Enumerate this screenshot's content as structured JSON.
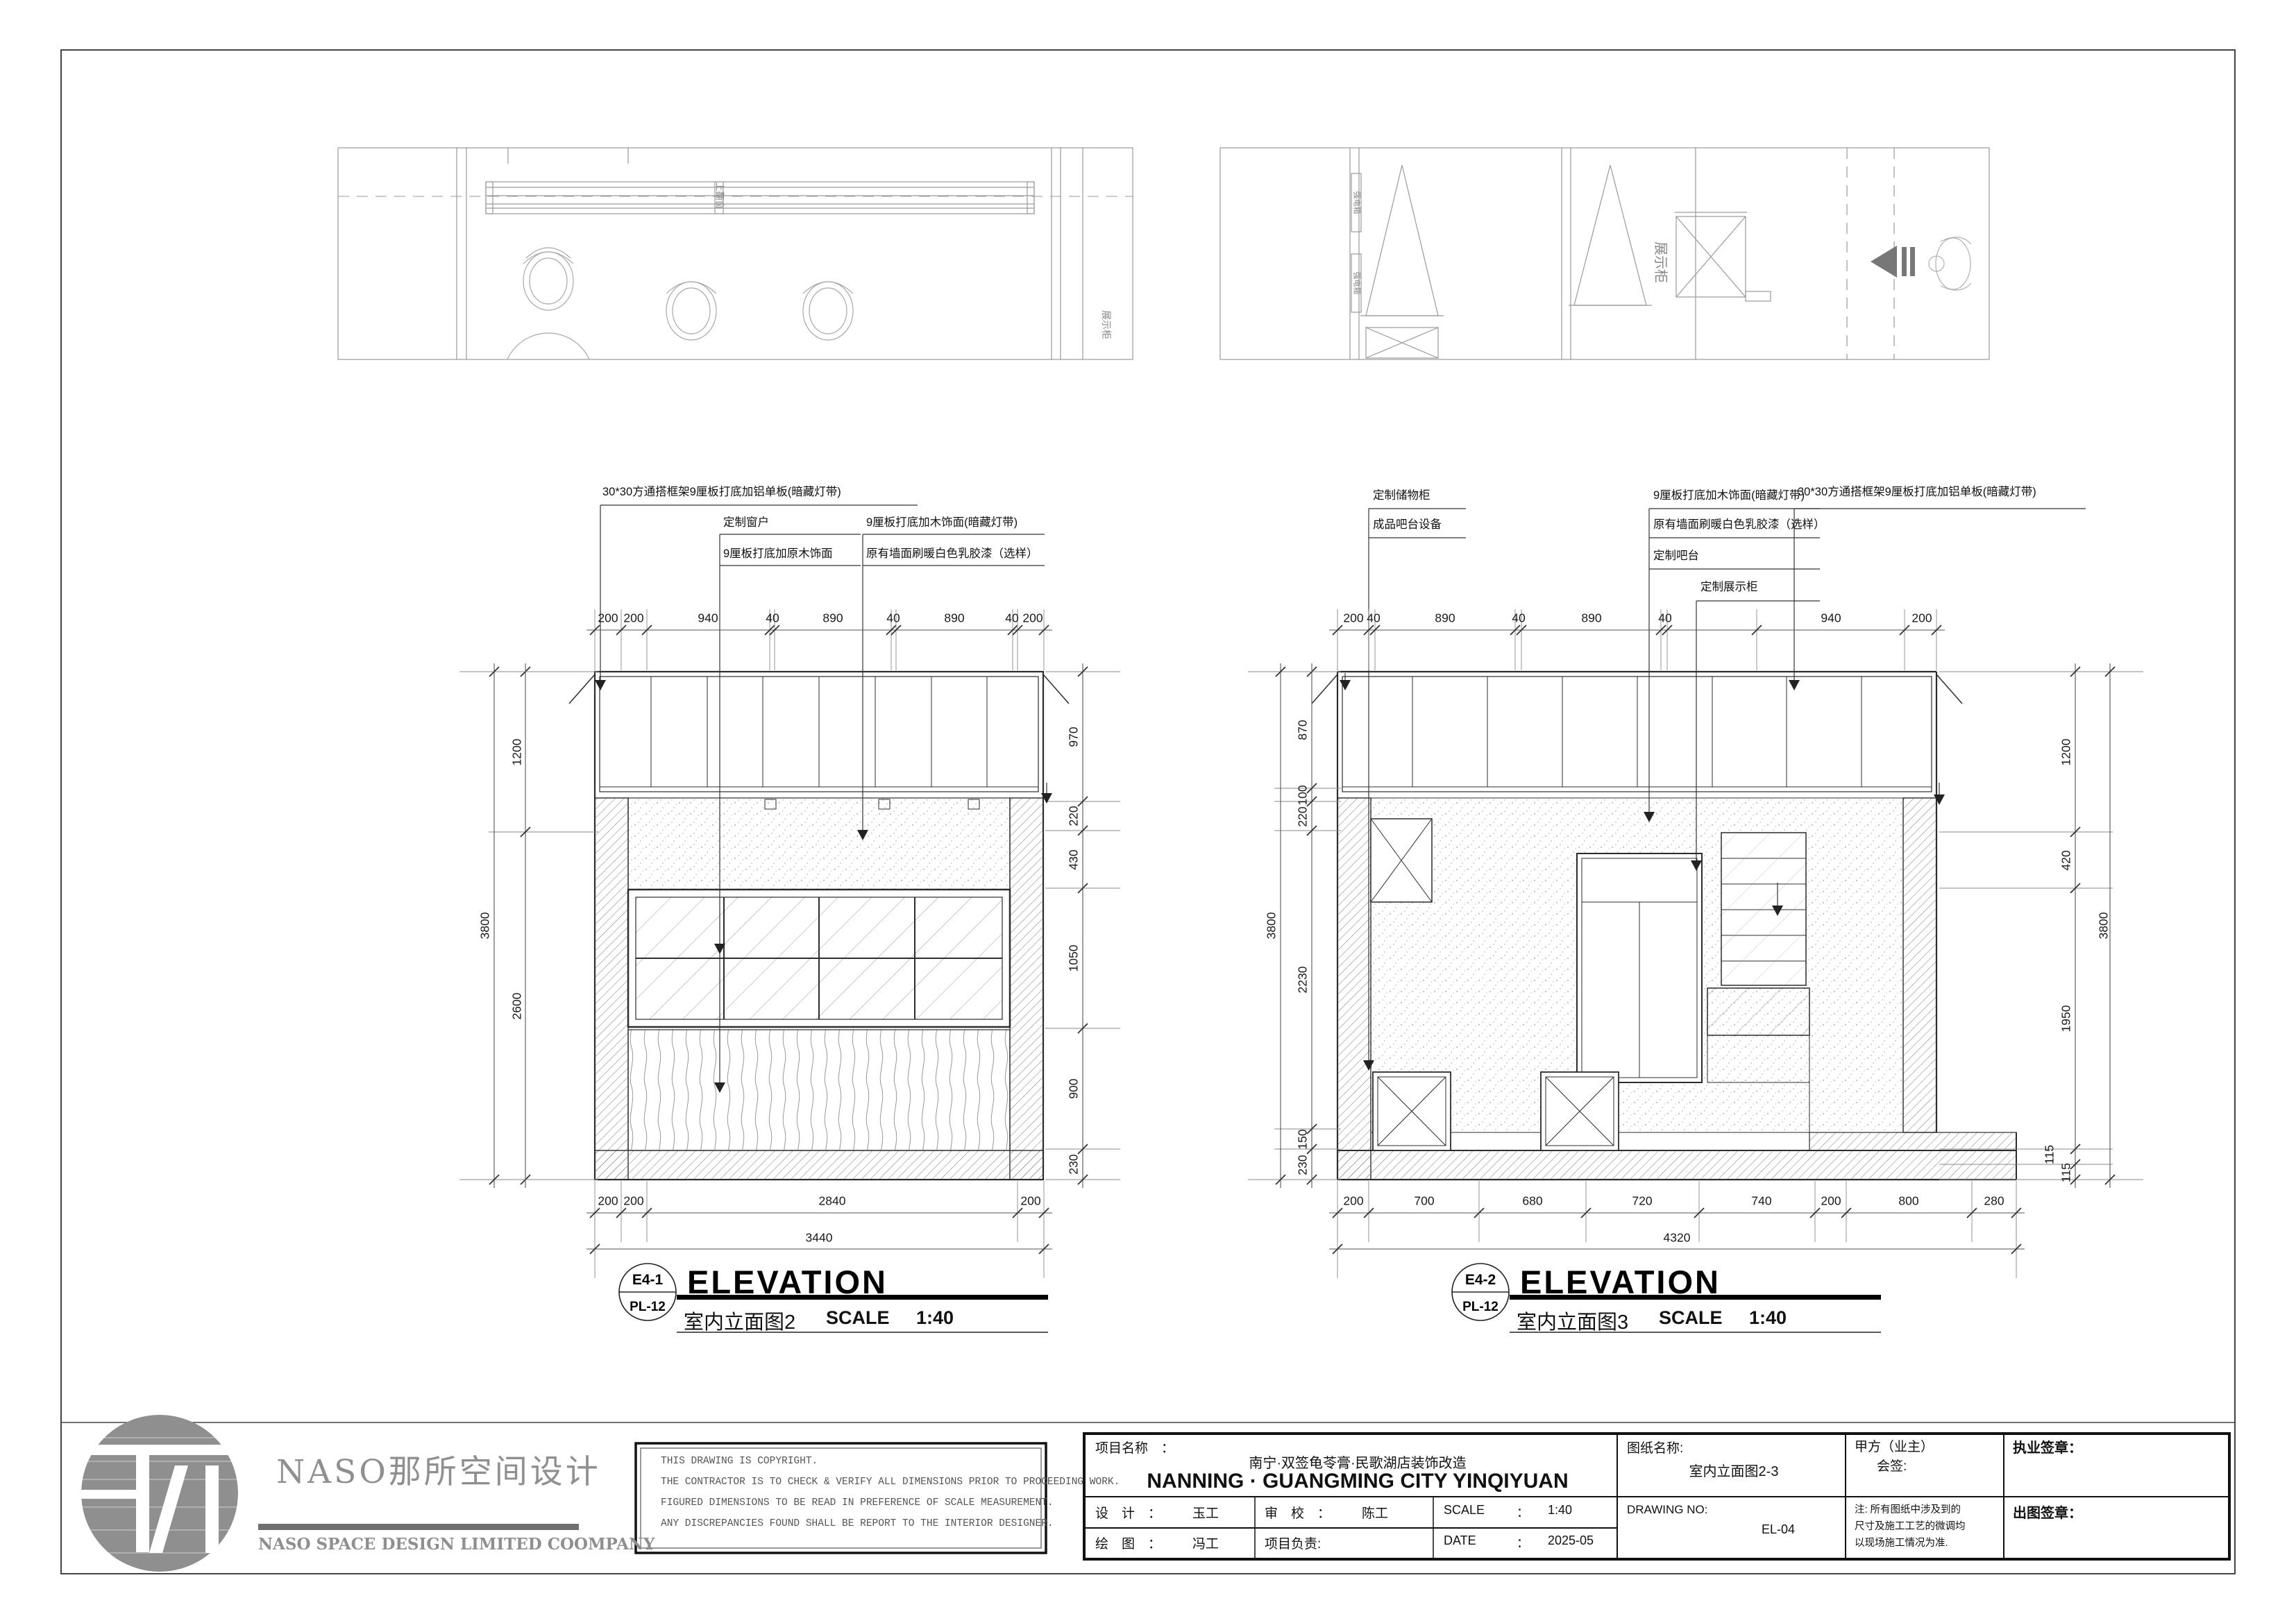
{
  "plan_left": {
    "window_label": "上翻窗",
    "cabinet_label": "展示柜"
  },
  "plan_right": {
    "power_box1": "强电箱",
    "power_box2": "强电箱",
    "cabinet_label": "展示柜"
  },
  "elev_left": {
    "ann1": "30*30方通搭框架9厘板打底加铝单板(暗藏灯带)",
    "ann2": "定制窗户",
    "ann3": "9厘板打底加原木饰面",
    "ann4": "9厘板打底加木饰面(暗藏灯带)",
    "ann5": "原有墙面刷暖白色乳胶漆（选样）",
    "dims_top": [
      "200",
      "200",
      "940",
      "40",
      "890",
      "40",
      "890",
      "40",
      "200"
    ],
    "dims_bottom": [
      "200",
      "200",
      "2840",
      "200"
    ],
    "total_bottom": "3440",
    "dims_left": [
      "1200",
      "2600"
    ],
    "total_left": "3800",
    "dims_right": [
      "970",
      "220",
      "430",
      "1050",
      "900",
      "230"
    ],
    "ref": "E4-1",
    "sheet_no": "PL-12",
    "title_en": "ELEVATION",
    "title_cn": "室内立面图2",
    "scale_label": "SCALE",
    "scale_value": "1:40"
  },
  "elev_right": {
    "ann1": "定制储物柜",
    "ann2": "成品吧台设备",
    "ann3": "9厘板打底加木饰面(暗藏灯带)",
    "ann4": "原有墙面刷暖白色乳胶漆（选样）",
    "ann5": "定制吧台",
    "ann6": "定制展示柜",
    "ann7": "30*30方通搭框架9厘板打底加铝单板(暗藏灯带)",
    "dims_top": [
      "200",
      "40",
      "890",
      "40",
      "890",
      "40",
      "940",
      "200"
    ],
    "dims_bottom": [
      "200",
      "700",
      "680",
      "720",
      "740",
      "200",
      "800",
      "280"
    ],
    "total_bottom": "4320",
    "dims_left": [
      "870",
      "100",
      "220",
      "2230",
      "150",
      "230"
    ],
    "total_left": "3800",
    "dims_right": [
      "1200",
      "420",
      "1950",
      "115",
      "115"
    ],
    "total_right": "3800",
    "ref": "E4-2",
    "sheet_no": "PL-12",
    "title_en": "ELEVATION",
    "title_cn": "室内立面图3",
    "scale_label": "SCALE",
    "scale_value": "1:40"
  },
  "title_block": {
    "logo_cn": "NASO那所空间设计",
    "logo_en": "NASO SPACE DESIGN LIMITED COOMPANY",
    "copyright_lines": [
      "THIS DRAWING IS COPYRIGHT.",
      "THE CONTRACTOR IS TO CHECK & VERIFY ALL DIMENSIONS PRIOR TO PROCEEDING WORK.",
      "FIGURED DIMENSIONS TO BE READ IN PREFERENCE OF SCALE MEASUREMENT.",
      "ANY DISCREPANCIES FOUND SHALL BE REPORT TO THE INTERIOR DESIGNER."
    ],
    "project_label": "项目名称　：",
    "project_cn": "南宁·双签龟苓膏·民歌湖店装饰改造",
    "project_en": "NANNING · GUANGMING CITY YINQIYUAN",
    "design_label": "设　计　：",
    "design_value": "玉工",
    "check_label": "审　校　：",
    "check_value": "陈工",
    "scale_label": "SCALE",
    "scale_sep": "：",
    "scale_value": "1:40",
    "draw_label": "绘　图　：",
    "draw_value": "冯工",
    "pm_label": "项目负责:",
    "date_label": "DATE",
    "date_sep": "：",
    "date_value": "2025-05",
    "sheet_name_label": "图纸名称:",
    "sheet_name_value": "室内立面图2-3",
    "drawing_no_label": "DRAWING NO:",
    "drawing_no_value": "EL-04",
    "client_label": "甲方（业主）",
    "client_sign_label": "会签:",
    "note_lines": [
      "注: 所有图纸中涉及到的",
      "尺寸及施工工艺的微调均",
      "以现场施工情况为准."
    ],
    "license_seal_label": "执业签章：",
    "issue_seal_label": "出图签章："
  }
}
